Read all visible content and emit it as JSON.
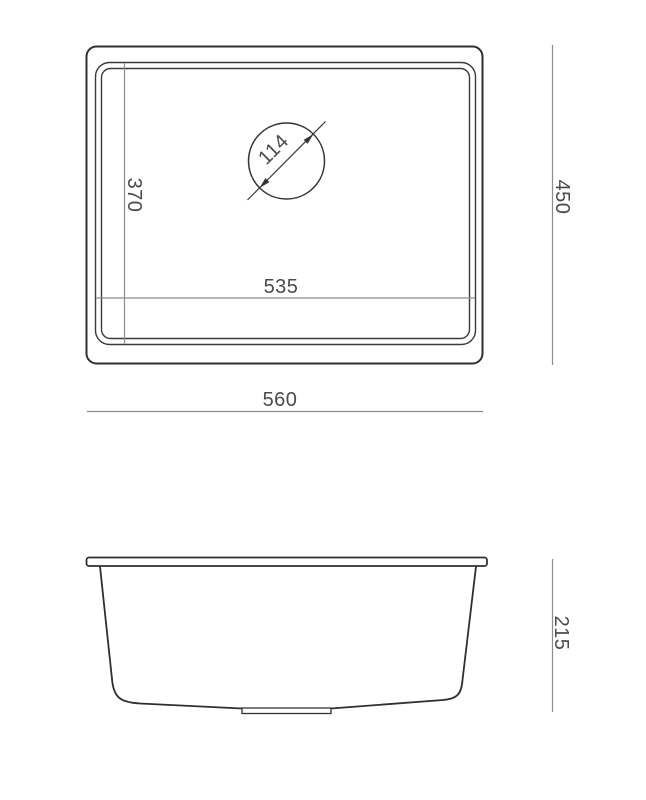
{
  "page": {
    "background": "#ffffff"
  },
  "drawing": {
    "type": "technical-dimension-drawing",
    "subject": "undermount rectangular sink, top view and side section view",
    "colors": {
      "outline": "#2f2f2f",
      "thin_line": "#3a3a3a",
      "dimension_line": "#8c8c8c",
      "text": "#4a4a4a",
      "background": "#ffffff"
    },
    "top_view": {
      "labels": {
        "overall_width": "560",
        "overall_depth": "450",
        "bowl_width": "535",
        "bowl_depth": "370",
        "drain_diameter": "114"
      }
    },
    "side_view": {
      "labels": {
        "height": "215"
      }
    }
  }
}
